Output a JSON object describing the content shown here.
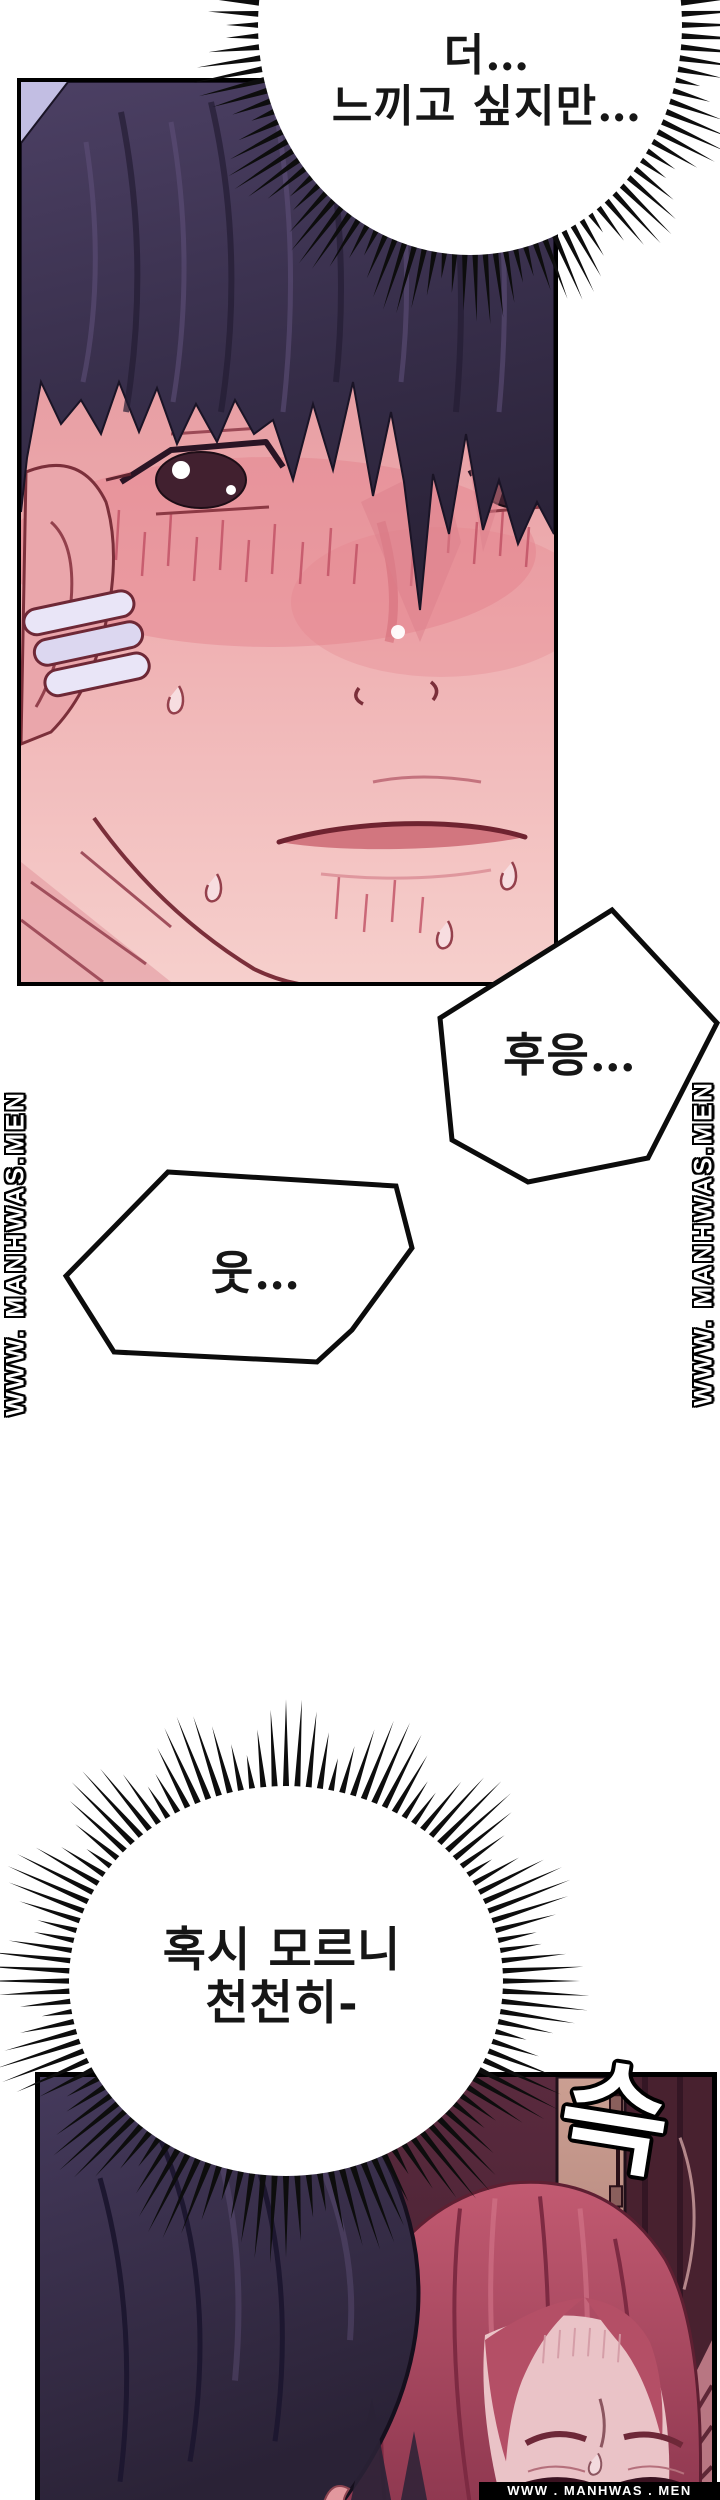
{
  "speech_bubbles": [
    {
      "id": "top-burst",
      "style": "burst-ellipse",
      "lines": [
        "더…",
        "느끼고 싶지만…"
      ]
    },
    {
      "id": "moan",
      "style": "jagged-polygon",
      "lines": [
        "후응…"
      ]
    },
    {
      "id": "grunt",
      "style": "jagged-polygon",
      "lines": [
        "웃…"
      ]
    },
    {
      "id": "bottom-burst",
      "style": "burst-ellipse",
      "lines": [
        "혹시 모르니",
        "천천히-"
      ]
    }
  ],
  "sfx": [
    {
      "id": "slide",
      "text": "슥"
    }
  ],
  "watermarks": {
    "left_vertical": "WWW. MANHWAS.MEN",
    "right_vertical": "WWW. MANHWAS.MEN",
    "bottom_bar": "WWW . MANHWAS . MEN"
  },
  "colors": {
    "page_bg": "#ffffff",
    "ink": "#0d0d0d",
    "bubble_fill": "#ffffff",
    "panel1_bg": "#c2bee3",
    "man_hair": "#352c46",
    "skin_pink": "#eeacaf",
    "blush": "#e2838e",
    "line_maroon": "#7b2f3a",
    "panel2_bg": "#54263a",
    "woman_hair": "#b85168",
    "door_tan": "#c89a8d"
  }
}
